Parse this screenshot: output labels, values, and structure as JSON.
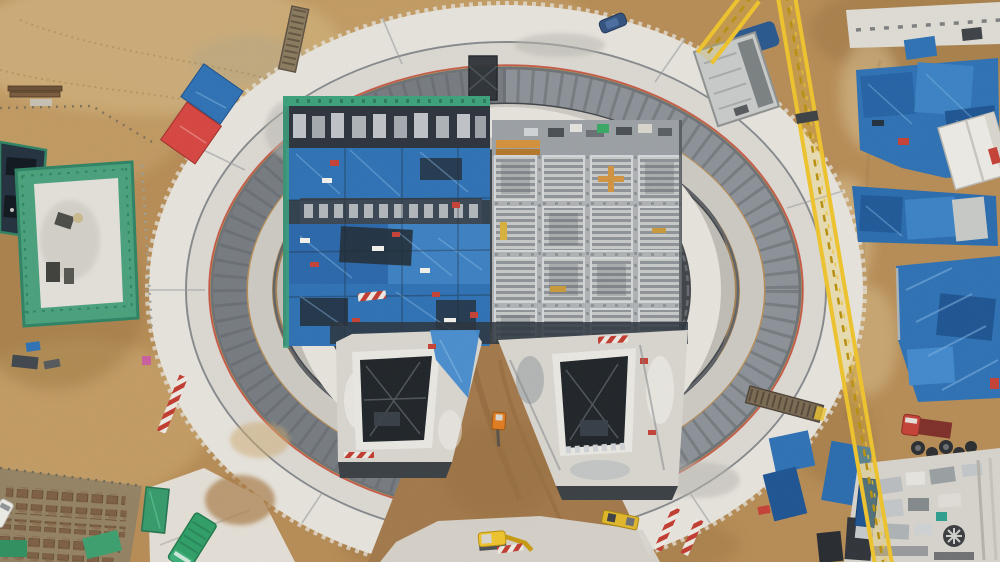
{
  "meta": {
    "title": "Aerial drone photograph of a circular construction site",
    "description": "Top-down drone view of a large circular concrete foundation ring under construction. Inside the ring sit two rectangular structures: one covered in blue tarpaulins with green scaffolding, one a grey grid of concrete formwork cells. Two deep shaft pits with dark openings flank a wedge of brown earth where a small excavator works. A yellow lattice tower-crane boom crosses the right side. Material laydown yards covered in blue tarps line the right edge; a green-fenced building with a white roof stands at the left; rust-coloured material racks fill the bottom-left corner; earth roads and bare soil surround everything."
  },
  "palette": {
    "dirt_base": "#b68c55",
    "dirt_light": "#cda970",
    "dirt_pale": "#dcc493",
    "dirt_dark": "#97713f",
    "concrete_white": "#e6e3dc",
    "concrete_light": "#d5d2cb",
    "concrete_mid": "#b7b5af",
    "concrete_dark": "#8f9396",
    "ring_band": "#8b9197",
    "ring_band_dark": "#5d6266",
    "inner_dark": "#474b4f",
    "navy": "#22303e",
    "tarp_blue": "#2e71b4",
    "tarp_blue_light": "#4289cc",
    "tarp_blue_dark": "#1d5492",
    "scaffold_green": "#3ca17b",
    "truck_green": "#2f9e66",
    "crane_yellow": "#eec32d",
    "crane_yellow_dark": "#b8900e",
    "red": "#c44136",
    "white": "#f2f0ea",
    "formwork": "#aeb2b5",
    "rust": "#7d5f43",
    "steel": "#6b6f72"
  },
  "scene": {
    "objects": [
      {
        "name": "circular-ring-structure",
        "label": "circular concrete foundation ring"
      },
      {
        "name": "tarp-covered-building",
        "label": "blue-tarp covered building inside ring"
      },
      {
        "name": "formwork-grid-building",
        "label": "grey formwork grid structure inside ring"
      },
      {
        "name": "left-shaft-pit",
        "label": "left shaft pit with dark opening"
      },
      {
        "name": "right-shaft-pit",
        "label": "right shaft pit with dark opening"
      },
      {
        "name": "earth-wedge",
        "label": "wedge of excavated earth with mini excavator"
      },
      {
        "name": "tower-crane-boom",
        "label": "yellow lattice tower crane boom"
      },
      {
        "name": "hoist-cabin",
        "label": "grey hoist cabin on ring edge"
      },
      {
        "name": "right-laydown-yard",
        "label": "blue tarped material laydown yards"
      },
      {
        "name": "white-canopy",
        "label": "white canopy shelter"
      },
      {
        "name": "green-fenced-building",
        "label": "green scaffolded building with white roof"
      },
      {
        "name": "material-racks",
        "label": "rust-coloured material racks"
      },
      {
        "name": "green-truck",
        "label": "green flatbed truck on ring road"
      },
      {
        "name": "excavator",
        "label": "yellow excavator at bottom road"
      },
      {
        "name": "red-truck",
        "label": "red dump truck"
      },
      {
        "name": "equipment-pad",
        "label": "concrete equipment pad bottom-right"
      }
    ]
  }
}
